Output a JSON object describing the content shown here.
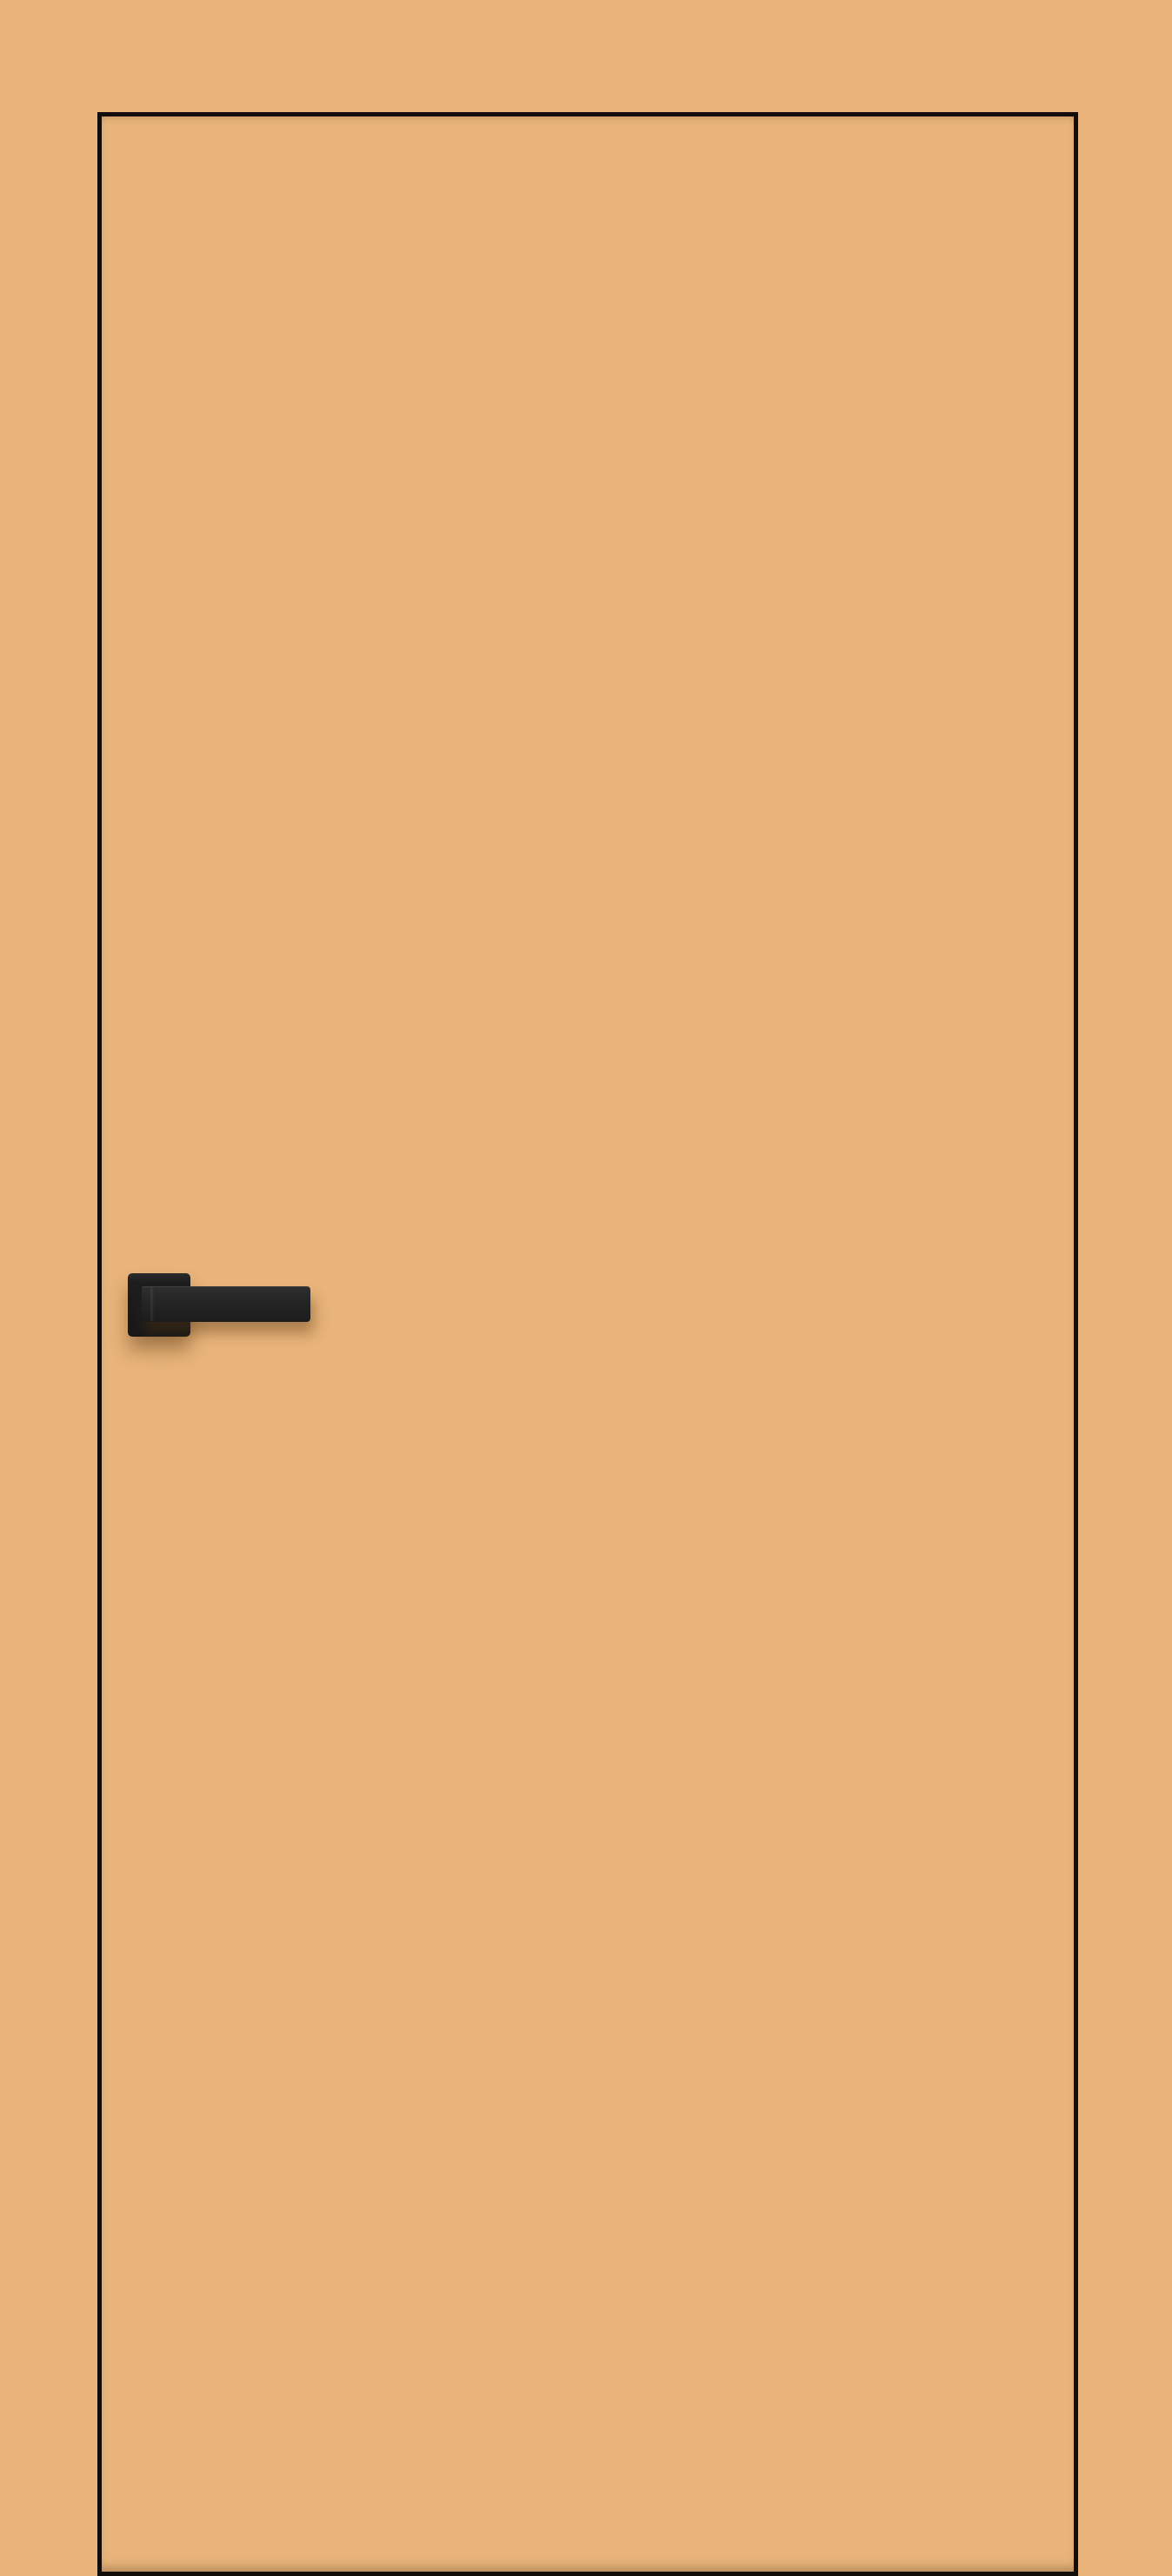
{
  "meta": {
    "type": "product-image",
    "subject": "Interior flush door, tan finish, with black square-rosette lever handle"
  },
  "scene": {
    "description": "Flat flush door slab in a tan/caramel finish shown against a matching tan backdrop; the slab is delineated by a thin black edge outline and fitted with a matte black square-rosette lever handle on the left stile, slightly above mid-height; soft brownish drop shadow beneath the handle; no text or labels visible",
    "objects": [
      "door-panel",
      "door-edge-outline",
      "door-handle",
      "handle-rosette-plate",
      "handle-lever"
    ]
  },
  "colors": {
    "background": "#e8b47a",
    "door_face": "#e8b47a",
    "door_outline": "#120d08",
    "handle_plate": "#1e1e1e",
    "handle_lever_light": "#2e2e2e",
    "handle_lever_dark": "#1c1c1c",
    "handle_highlight": "rgba(255,255,255,0.14)",
    "shadow": "rgba(86,52,16,0.42)"
  }
}
